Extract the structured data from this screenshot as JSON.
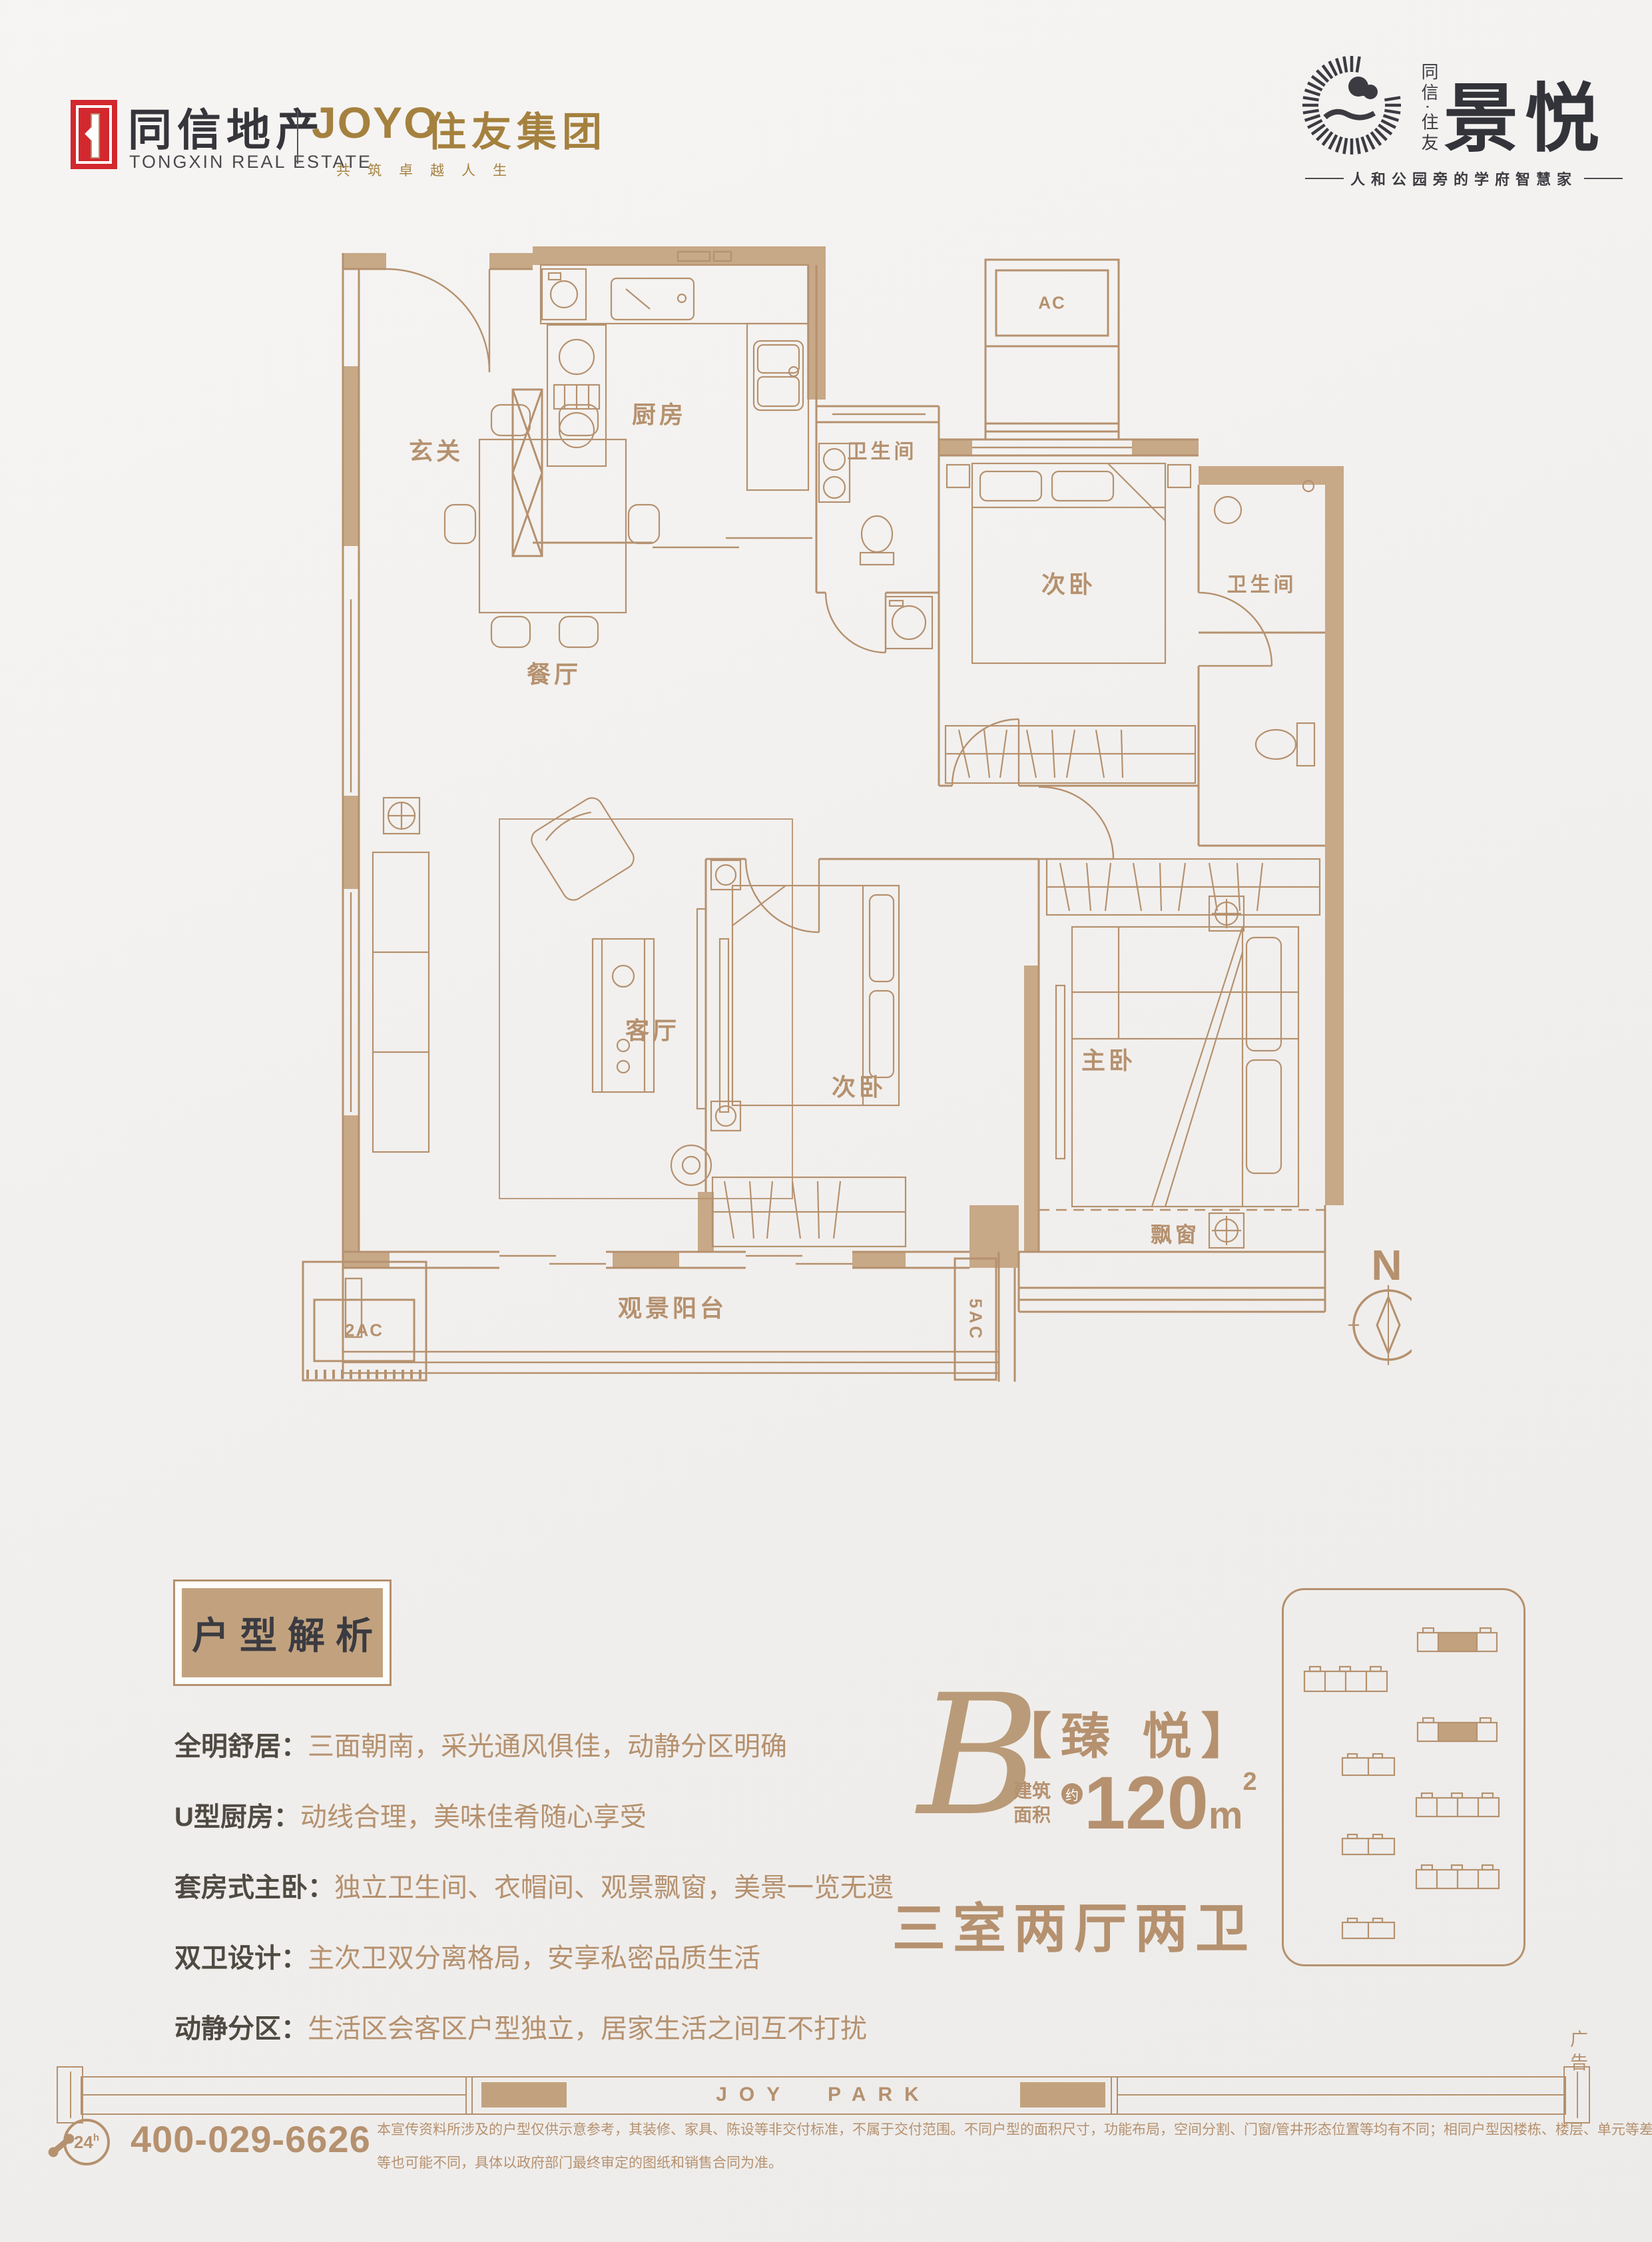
{
  "colors": {
    "tan": "#b5916f",
    "wall_fill": "#c7a887",
    "dark": "#3b3b41",
    "red": "#d2282e",
    "gold": "#a5813f"
  },
  "header": {
    "left": {
      "brand_cn": "同信地产",
      "brand_en": "TONGXIN REAL ESTATE",
      "partner_name": "JOYO",
      "partner_cn": "住友集团",
      "partner_tagline": "共筑卓越人生"
    },
    "right": {
      "vertical_brand": "同信·住友",
      "project_name": "景悦",
      "tagline": "人和公园旁的学府智慧家"
    }
  },
  "floorplan": {
    "rooms": [
      {
        "label": "玄关"
      },
      {
        "label": "厨房"
      },
      {
        "label": "卫生间"
      },
      {
        "label": "次卧"
      },
      {
        "label": "卫生间"
      },
      {
        "label": "餐厅"
      },
      {
        "label": "客厅"
      },
      {
        "label": "次卧"
      },
      {
        "label": "主卧"
      },
      {
        "label": "飘窗"
      },
      {
        "label": "观景阳台"
      }
    ],
    "ac_top": "AC",
    "ac_left": "2AC",
    "ac_right": "5AC",
    "compass": "N"
  },
  "analysis": {
    "title": "户型解析",
    "items": [
      {
        "label": "全明舒居：",
        "text": "三面朝南，采光通风俱佳，动静分区明确"
      },
      {
        "label": "U型厨房：",
        "text": "动线合理，美味佳肴随心享受"
      },
      {
        "label": "套房式主卧：",
        "text": "独立卫生间、衣帽间、观景飘窗，美景一览无遗"
      },
      {
        "label": "双卫设计：",
        "text": "主次卫双分离格局，安享私密品质生活"
      },
      {
        "label": "动静分区：",
        "text": "生活区会客区户型独立，居家生活之间互不打扰"
      }
    ]
  },
  "unit": {
    "letter": "B",
    "name": "【臻 悦】",
    "area_cap_1": "建筑",
    "area_cap_2": "面积",
    "approx": "约",
    "area_value": "120",
    "area_unit": "m",
    "area_sup": "2",
    "layout": "三室两厅两卫"
  },
  "footer": {
    "park_text": "JOY PARK",
    "ad_vertical": "广告",
    "phone": "400-029-6626",
    "badge": "24",
    "badge_sup": "h",
    "disclaimer1": "本宣传资料所涉及的户型仅供示意参考，其装修、家具、陈设等非交付标准，不属于交付范围。不同户型的面积尺寸，功能布局，空间分割、门窗/管井形态位置等均有不同；相同户型因楼栋、楼层、单元等差别，局部结构、面积",
    "disclaimer2": "等也可能不同，具体以政府部门最终审定的图纸和销售合同为准。"
  }
}
